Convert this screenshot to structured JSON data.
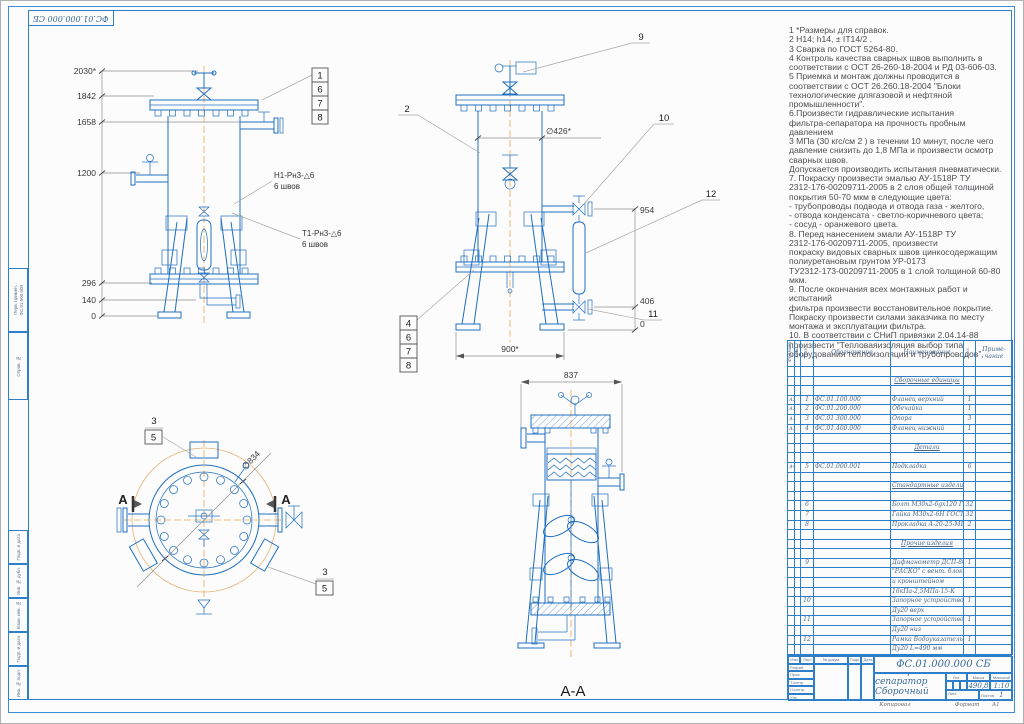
{
  "frame": {
    "corner_stamp": "ФС.01.000.000 СБ",
    "side_cells": [
      "Перв. примен.",
      "Справ. №",
      "Подп. и дата",
      "Инв. № дубл.",
      "Взам. инв. №",
      "Подп. и дата",
      "Инв. № подл."
    ],
    "side_ref": "ФС.01.000.000",
    "copy_label": "Копировал",
    "format_label": "Формат",
    "format_value": "А1"
  },
  "notes": {
    "lines": [
      "1  *Размеры для справок.",
      "2  Н14; h14, ±  IT14/2 .",
      "3  Сварка по ГОСТ 5264-80.",
      "4  Контроль качества сварных швов выполнить в",
      "соответствии с ОСТ 26-260-18-2004 и РД 03-606-03.",
      "5  Приемка и монтаж должны проводится в",
      "соответствии с ОСТ  26.260.18-2004 \"Блоки",
      "технологические длягазовой и нефтяной",
      "промышленности\".",
      "6.Произвести гидравлические испытания",
      "фильтра-сепаратора на прочность пробным давлением",
      "3 МПа (30 кгс/см 2 ) в течении 10 минут, после чего",
      "давление снизить до 1,8 МПа и  произвести осмотр",
      "сварных швов.",
      " Допускается производить испытания пневматически.",
      " 7. Покраску произвести эмалью АУ-1518Р ТУ",
      "2312-176-00209711-2005 в 2 слоя  общей толщиной",
      "покрытия 50-70 мкм в следующие цвета:",
      " - трубопроводы подвода и отвода газа - желтого,",
      " -  отвода конденсата - светло-коричневого цвета;",
      "  - сосуд - оранжевого  цвета.",
      " 8. Перед нанесением эмали АУ-1518Р ТУ",
      "2312-176-00209711-2005, произвести",
      " покраску видовых сварных швов цинкосодержащим",
      "полиуретановым грунтом УР-0173",
      "ТУ2312-173-00209711-2005 в 1 слой толщиной 60-80",
      "мкм.",
      "9. После окончания всех монтажных работ и испытаний",
      "фильтра   произвести восстановительное покрытие.",
      "Покраску произвести силами заказчика по месту",
      "монтажа и эксплуатации фильтра.",
      "10. В соответствии с СНиП привязки 2.04.14-88",
      "произвести \"Тепловаяизоляция выбор типа",
      "оборудования теплоизоляции и  трубопроводов\","
    ]
  },
  "views": {
    "front": {
      "dims": [
        "2030*",
        "1842",
        "1658",
        "1200",
        "296",
        "140",
        "0"
      ],
      "callouts": [
        "1",
        "6",
        "7",
        "8"
      ],
      "weld_top": "Н1-Рн3-△6",
      "weld_top_sub": "6 швов",
      "weld_bottom": "Т1-Рн3-△6",
      "weld_bottom_sub": "6 швов"
    },
    "side": {
      "callout_9": "9",
      "callout_2": "2",
      "callout_10": "10",
      "callout_11": "11",
      "callout_12": "12",
      "dia": "∅426*",
      "dim_954": "954",
      "dim_406": "406",
      "dim_zero": "0",
      "dim_900": "900*",
      "callouts": [
        "4",
        "6",
        "7",
        "8"
      ]
    },
    "plan": {
      "dia": "∅834",
      "callout_3a": "3",
      "callout_5a": "5",
      "callout_3b": "3",
      "callout_5b": "5",
      "letter_a_left": "А",
      "letter_a_right": "А"
    },
    "section": {
      "dim_837": "837",
      "label": "А-А"
    }
  },
  "spec": {
    "col_headers": {
      "format": "Формат",
      "zone": "Зона",
      "pos": "Поз.",
      "designation": "Обозначение",
      "name": "Наименование",
      "qty": "Кол.",
      "note1": "Приме-",
      "note2": "чание"
    },
    "rows": [
      {},
      {
        "sec": true,
        "n": "Сборочные единицы"
      },
      {},
      {
        "f": "А3",
        "pos": "1",
        "d": "ФС.01.100.000",
        "n": "Фланец верхний",
        "q": "1"
      },
      {
        "f": "А3",
        "pos": "2",
        "d": "ФС.01.200.000",
        "n": "Обечайка",
        "q": "1"
      },
      {
        "f": "А3",
        "pos": "3",
        "d": "ФС.01.300.000",
        "n": "Опора",
        "q": "3"
      },
      {
        "f": "А3",
        "pos": "4",
        "d": "ФС.01.400.000",
        "n": "Фланец нижний",
        "q": "1"
      },
      {},
      {
        "sec": true,
        "n": "Детали"
      },
      {},
      {
        "f": "А4",
        "pos": "5",
        "d": "ФС.01.000.001",
        "n": "Подкладка",
        "q": "6"
      },
      {},
      {
        "sec": true,
        "n": "Стандартные изделия"
      },
      {},
      {
        "pos": "6",
        "n": "Болт М30х2-6gх120 ГОСТ 7796-70",
        "q": "32"
      },
      {
        "pos": "7",
        "n": "Гайка М30х2-6Н ГОСТ 15521-70",
        "q": "32"
      },
      {
        "pos": "8",
        "n": "Прокладка А-20-25-МБ ГОСТ 15180-86",
        "q": "2"
      },
      {},
      {
        "sec": true,
        "n": "Прочие изделия"
      },
      {},
      {
        "pos": "9",
        "n": "Дифманометр ДСП-80В",
        "q": "1"
      },
      {
        "n": "\"РАСКО\" с вент. блоком"
      },
      {
        "n": "и кронштейном"
      },
      {
        "n": "16кПа-2,5МПа-15-К"
      },
      {
        "pos": "10",
        "n": "Запорное устройство 12нж10бк",
        "q": "1"
      },
      {
        "n": "Ду20 верх"
      },
      {
        "pos": "11",
        "n": "Запорное устройство 12нж10бк",
        "q": "1"
      },
      {
        "n": "Ду20 низ"
      },
      {
        "pos": "12",
        "n": "Рамка Водоуказательная 12нж10бк",
        "q": "1"
      },
      {
        "n": "Ду20 L=490 мм"
      }
    ]
  },
  "title_block": {
    "doc_number": "ФС.01.000.000 СБ",
    "title_line1": "Фильтр-сепаратор",
    "title_line2": "Сборочный чертеж",
    "mass": "490,8",
    "scale": "1:10",
    "lit_label": "Лит.",
    "mass_label": "Масса",
    "scale_label": "Масштаб",
    "sheet_label": "Лист",
    "sheets_label": "Листов",
    "sheets_value": "1",
    "row_labels": [
      "Изм.",
      "Лист",
      "№ докум.",
      "Подп.",
      "Дата"
    ],
    "sign_labels": [
      "Разраб.",
      "Пров.",
      "Т.контр.",
      "Н.контр.",
      "Утв."
    ]
  }
}
